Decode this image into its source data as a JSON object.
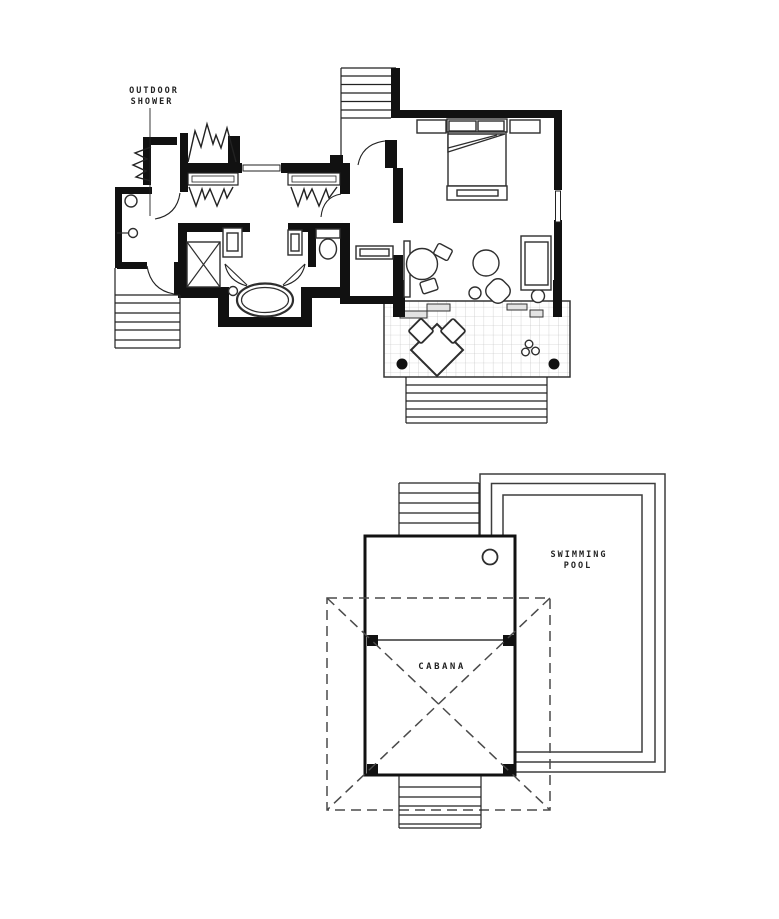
{
  "canvas": {
    "width": 779,
    "height": 919,
    "background": "#ffffff"
  },
  "palette": {
    "ink": "#111111",
    "furniture_line": "#2e2e2e",
    "pool_line": "#3d3d3d",
    "tile_grid": "#bbbbbb",
    "roof_dash": "#4a4a4a",
    "label_text": "#222222"
  },
  "upper_plan": {
    "name": "villa-floor-plan",
    "labels": {
      "outdoor_shower_line1": "OUTDOOR",
      "outdoor_shower_line2": "SHOWER"
    },
    "features": [
      "entry-stairs",
      "bedroom",
      "bed",
      "closet",
      "sofa",
      "round-table",
      "ottoman",
      "fan-chair",
      "terrace",
      "terrace-stairs",
      "bathroom",
      "shower-stall",
      "bathtub",
      "toilet",
      "vanities",
      "outdoor-shower-room",
      "side-stairs",
      "folding-screens"
    ]
  },
  "lower_plan": {
    "name": "cabana-and-pool-plan",
    "labels": {
      "swimming_pool_line1": "SWIMMING",
      "swimming_pool_line2": "POOL",
      "cabana": "CABANA"
    },
    "features": [
      "swimming-pool",
      "cabana",
      "cabana-posts",
      "cabana-roof-dashed",
      "upper-stairs",
      "lower-stairs"
    ]
  }
}
